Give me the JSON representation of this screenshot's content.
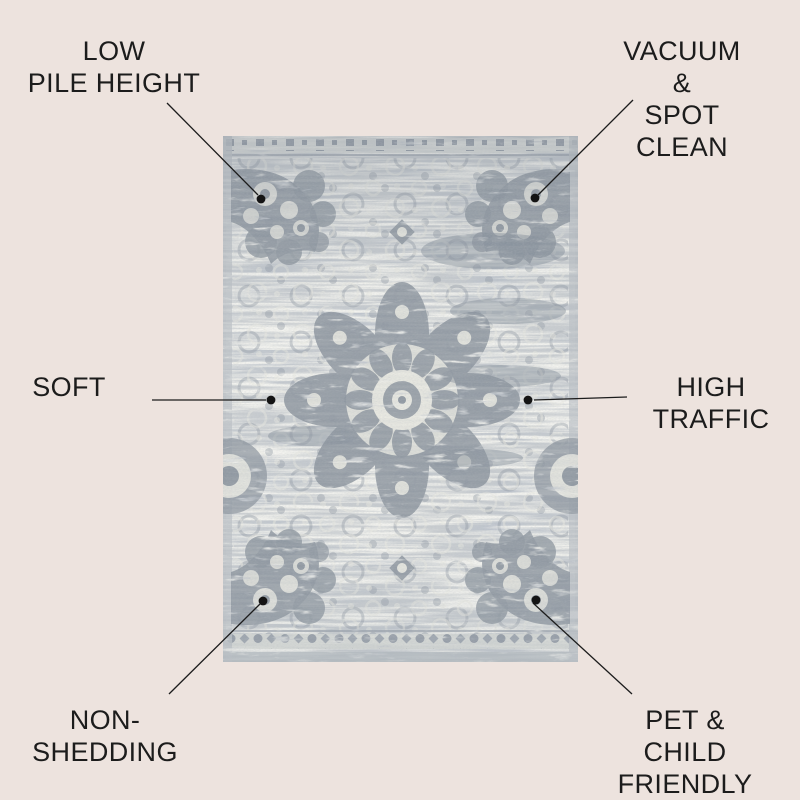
{
  "background_color": "#ede3de",
  "text_color": "#1c1c1c",
  "connector_color": "#1c1c1c",
  "rug": {
    "name": "gray-distressed-medallion-area-rug",
    "colors": {
      "base": "#c9cdd0",
      "pattern_dark": "#87909a",
      "pattern_light": "#e9e9e1",
      "border_band": "#dcdeda"
    }
  },
  "callouts": [
    {
      "id": "low-pile-height",
      "text": "LOW\nPILE HEIGHT"
    },
    {
      "id": "vacuum-spot-clean",
      "text": "VACUUM &\nSPOT CLEAN"
    },
    {
      "id": "soft",
      "text": "SOFT"
    },
    {
      "id": "high-traffic",
      "text": "HIGH\nTRAFFIC"
    },
    {
      "id": "non-shedding",
      "text": "NON-\nSHEDDING"
    },
    {
      "id": "pet-child-friendly",
      "text": "PET & CHILD\nFRIENDLY"
    }
  ]
}
